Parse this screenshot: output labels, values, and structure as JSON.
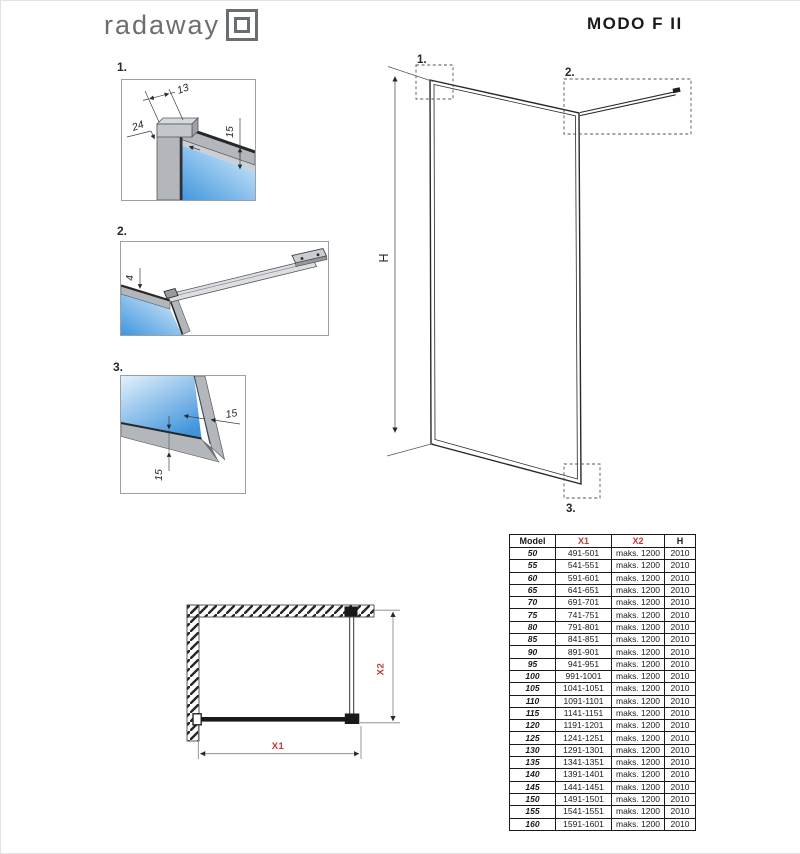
{
  "header": {
    "brand": "radaway",
    "product": "MODO F II"
  },
  "colors": {
    "accent_red": "#bf3a3a",
    "drawing_line": "#26282a",
    "profile_gray": "#b3b6ba",
    "glass_blue": "#3f96de",
    "glass_light": "#ddeefb",
    "logo_gray": "#6b6e71"
  },
  "figures": {
    "detail1": {
      "label": "1.",
      "dim_top": "13",
      "dim_left": "24",
      "dim_right": "15"
    },
    "detail2": {
      "label": "2.",
      "dim_left": "4"
    },
    "detail3": {
      "label": "3.",
      "dim_right": "15",
      "dim_bottom": "15"
    },
    "elevation": {
      "callout1": "1.",
      "callout2": "2.",
      "callout3": "3.",
      "height_label": "H"
    },
    "plan": {
      "width_label": "X1",
      "depth_label": "X2"
    }
  },
  "table": {
    "headers": [
      "Model",
      "X1",
      "X2",
      "H"
    ],
    "rows": [
      [
        "50",
        "491-501",
        "maks. 1200",
        "2010"
      ],
      [
        "55",
        "541-551",
        "maks. 1200",
        "2010"
      ],
      [
        "60",
        "591-601",
        "maks. 1200",
        "2010"
      ],
      [
        "65",
        "641-651",
        "maks. 1200",
        "2010"
      ],
      [
        "70",
        "691-701",
        "maks. 1200",
        "2010"
      ],
      [
        "75",
        "741-751",
        "maks. 1200",
        "2010"
      ],
      [
        "80",
        "791-801",
        "maks. 1200",
        "2010"
      ],
      [
        "85",
        "841-851",
        "maks. 1200",
        "2010"
      ],
      [
        "90",
        "891-901",
        "maks. 1200",
        "2010"
      ],
      [
        "95",
        "941-951",
        "maks. 1200",
        "2010"
      ],
      [
        "100",
        "991-1001",
        "maks. 1200",
        "2010"
      ],
      [
        "105",
        "1041-1051",
        "maks. 1200",
        "2010"
      ],
      [
        "110",
        "1091-1101",
        "maks. 1200",
        "2010"
      ],
      [
        "115",
        "1141-1151",
        "maks. 1200",
        "2010"
      ],
      [
        "120",
        "1191-1201",
        "maks. 1200",
        "2010"
      ],
      [
        "125",
        "1241-1251",
        "maks. 1200",
        "2010"
      ],
      [
        "130",
        "1291-1301",
        "maks. 1200",
        "2010"
      ],
      [
        "135",
        "1341-1351",
        "maks. 1200",
        "2010"
      ],
      [
        "140",
        "1391-1401",
        "maks. 1200",
        "2010"
      ],
      [
        "145",
        "1441-1451",
        "maks. 1200",
        "2010"
      ],
      [
        "150",
        "1491-1501",
        "maks. 1200",
        "2010"
      ],
      [
        "155",
        "1541-1551",
        "maks. 1200",
        "2010"
      ],
      [
        "160",
        "1591-1601",
        "maks. 1200",
        "2010"
      ]
    ]
  }
}
